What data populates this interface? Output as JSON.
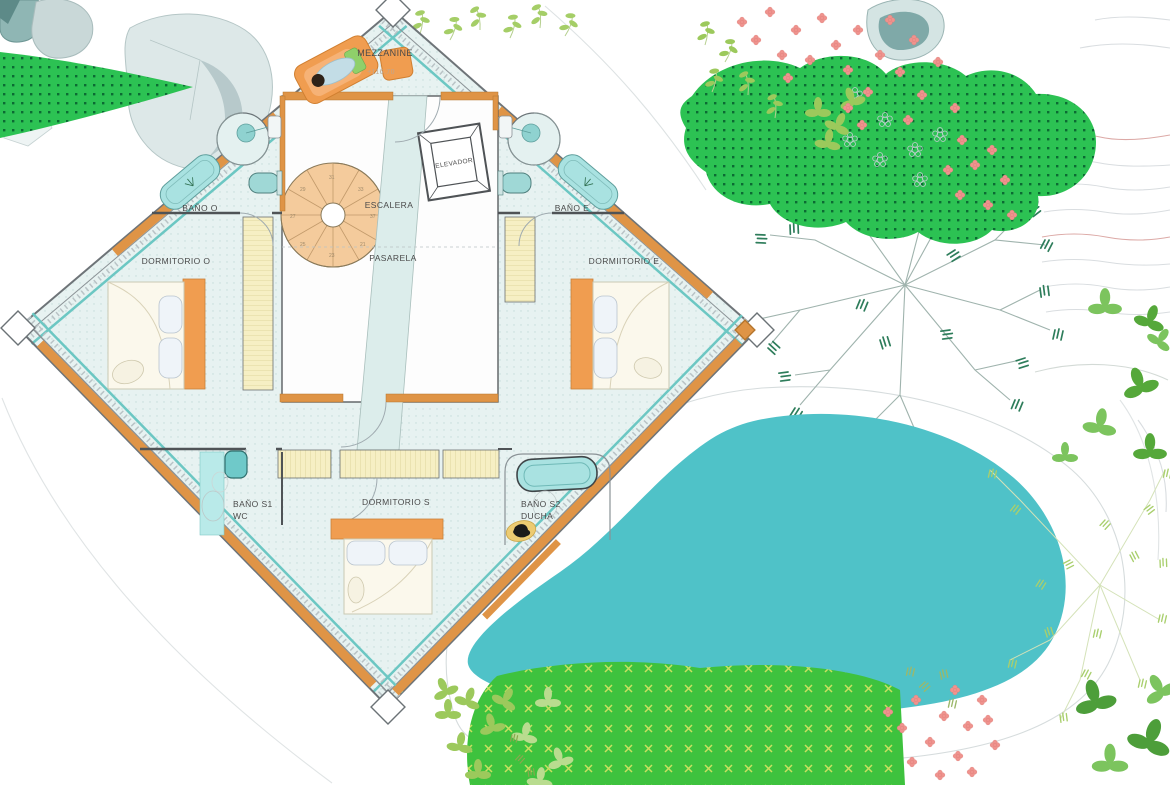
{
  "plan": {
    "labels": {
      "mezzanine": "MEZZANINE",
      "elevation": "+116.70",
      "escalera": "ESCALERA",
      "pasarela": "PASARELA",
      "elevador": "ELEVADOR",
      "bano_o": "BAÑO O",
      "dormitorio_o": "DORMITORIO O",
      "bano_e": "BAÑO E",
      "dormitorio_e": "DORMIITORIO E",
      "bano_s1": "BAÑO S1",
      "wc": "WC",
      "dormitorio_s": "DORMITORIO S",
      "bano_s2": "BAÑO S2",
      "ducha": "DUCHA"
    },
    "stairs": {
      "numbers": [
        "21",
        "23",
        "25",
        "27",
        "29",
        "31",
        "33",
        "37"
      ]
    }
  },
  "colors": {
    "pool": "#4fc2c8",
    "lawn_green": "#2cc253",
    "lawn_dot": "#0b6b33",
    "band_green": "#3ec23e",
    "band_mark": "#c9e060",
    "wood_orange": "#df9446",
    "furniture_orange": "#f09d50",
    "wardrobe_yellow": "#f6efc4",
    "floor": "#e7f2f1",
    "stair_fill": "#f4cb9c",
    "fixture_teal": "#a9e2e1",
    "glass_teal": "#6cc7c3",
    "wall_grey": "#4f5356",
    "leaf_light": "#a5ce67",
    "leaf_mid": "#7cc45e",
    "leaf_dark": "#55a83a",
    "flower_pink": "#ef938e",
    "rock_grey": "#c9d8d8",
    "rock_teal": "#7fa9a8",
    "contour_grey": "#d9dde0",
    "contour_red": "#dca9a6",
    "text": "#4a4a4a"
  }
}
